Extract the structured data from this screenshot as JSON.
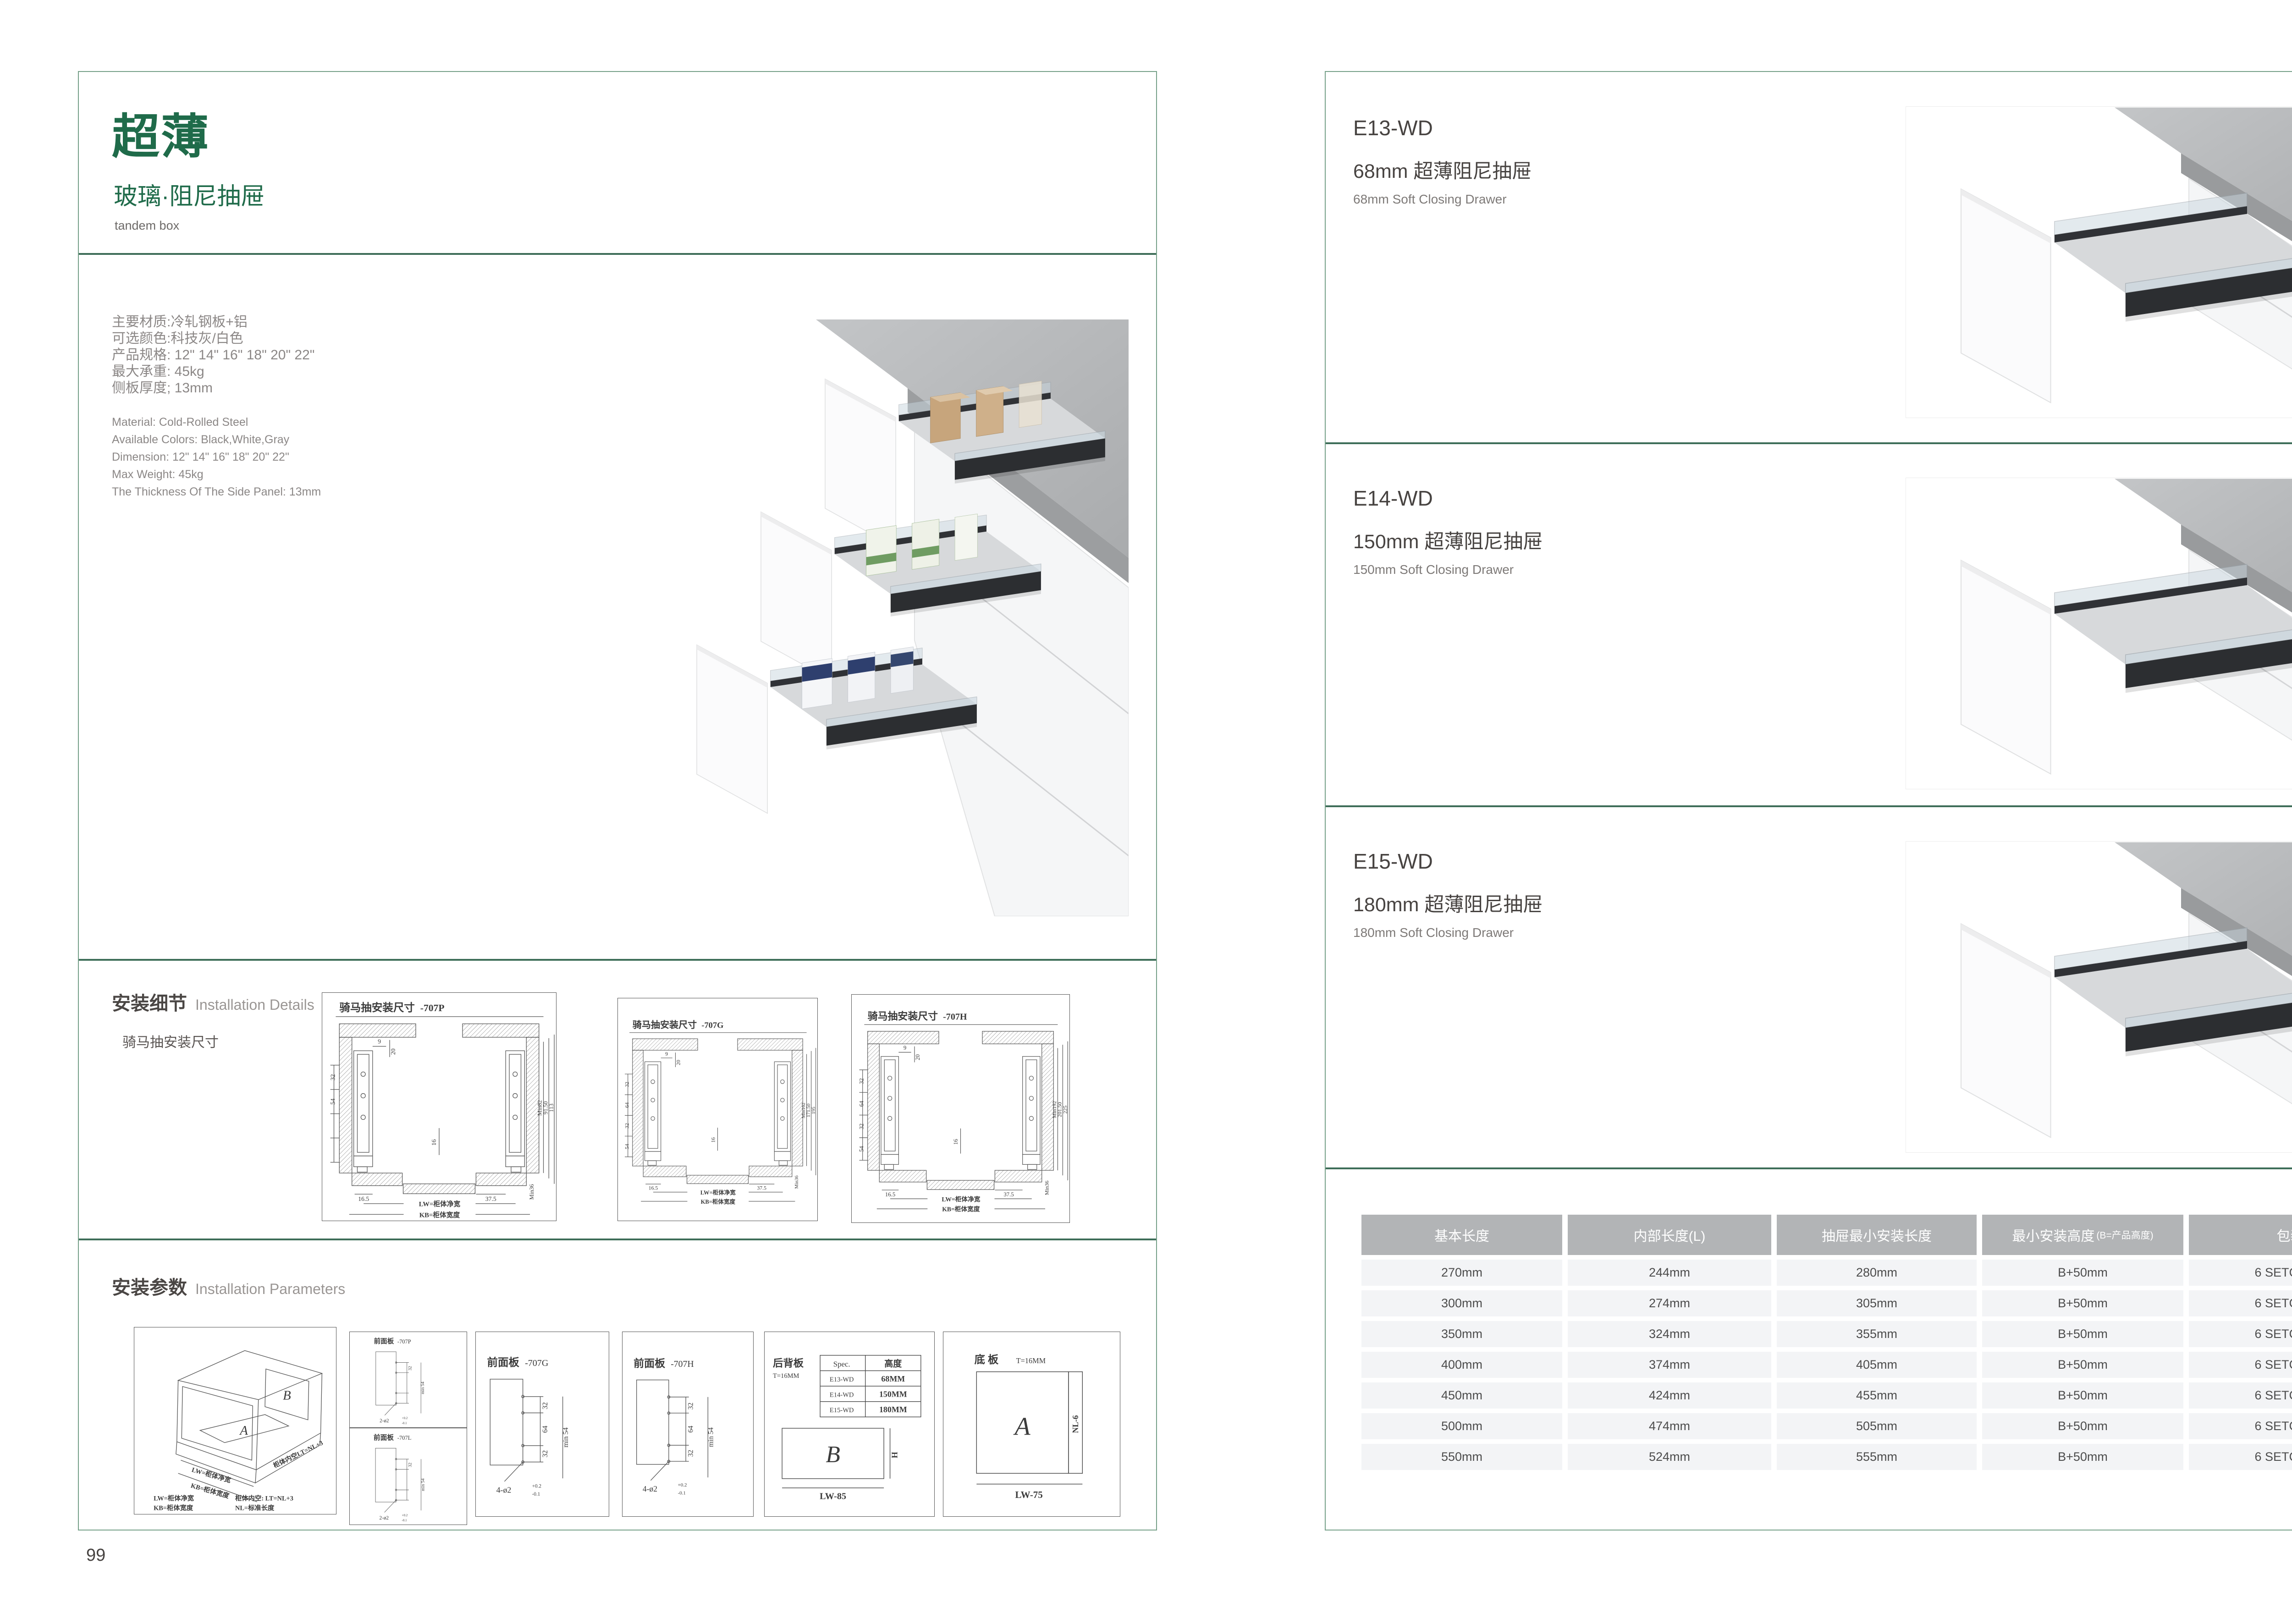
{
  "colors": {
    "brand_green": "#1f6b4a",
    "border_green": "#76a089",
    "divider_green": "#3e6e59",
    "table_header_bg": "#b2b4b6",
    "table_row_bg": "#f3f4f6"
  },
  "page_left": {
    "page_number": "99",
    "header": {
      "title": "超薄",
      "subtitle": "玻璃·阻尼抽屉",
      "tagline": "tandem box"
    },
    "specs_zh": [
      "主要材质:冷轧钢板+铝",
      "可选颜色:科技灰/白色",
      "产品规格: 12\" 14\" 16\" 18\" 20\" 22\"",
      "最大承重: 45kg",
      "侧板厚度; 13mm"
    ],
    "specs_en": [
      "Material: Cold-Rolled Steel",
      "Available Colors: Black,White,Gray",
      "Dimension: 12\" 14\" 16\" 18\" 20\" 22\"",
      "Max Weight: 45kg",
      "The Thickness Of The Side Panel: 13mm"
    ],
    "details": {
      "title_zh": "安装细节",
      "title_en": "Installation Details",
      "subtitle": "骑马抽安装尺寸",
      "drawings": [
        {
          "title": "骑马抽安装尺寸",
          "model": "-707P",
          "top_dim": "9",
          "slot_dim": "20",
          "left_dims": [
            "32",
            "54",
            "",
            ""
          ],
          "mid_dim": "16",
          "right_dims": [
            "Min82",
            "91.50",
            "113"
          ],
          "bottom_left": "16.5",
          "bottom_right": "37.5",
          "min_label": "Min36",
          "lw": "LW=柜体净宽",
          "kb": "KB=柜体宽度"
        },
        {
          "title": "骑马抽安装尺寸",
          "model": "-707G",
          "top_dim": "9",
          "slot_dim": "20",
          "left_dims": [
            "32",
            "64",
            "32",
            "54"
          ],
          "mid_dim": "16",
          "right_dims": [
            "Min162",
            "171.50",
            "195"
          ],
          "bottom_left": "16.5",
          "bottom_right": "37.5",
          "min_label": "Min36",
          "lw": "LW=柜体净宽",
          "kb": "KB=柜体宽度"
        },
        {
          "title": "骑马抽安装尺寸",
          "model": "-707H",
          "top_dim": "9",
          "slot_dim": "20",
          "left_dims": [
            "32",
            "64",
            "32",
            "54"
          ],
          "mid_dim": "16",
          "right_dims": [
            "Min192",
            "201.50",
            "225"
          ],
          "bottom_left": "16.5",
          "bottom_right": "37.5",
          "min_label": "Min36",
          "lw": "LW=柜体净宽",
          "kb": "KB=柜体宽度"
        }
      ]
    },
    "params": {
      "title_zh": "安装参数",
      "title_en": "Installation Parameters",
      "cabinet": {
        "panel_a": "A",
        "panel_b": "B",
        "lw": "LW=柜体净宽",
        "kb": "KB=柜体宽度",
        "lt": "柜体内空LT=NL+3",
        "legend": [
          "LW=柜体净宽",
          "柜体内空: LT=NL+3",
          "KB=柜体宽度",
          "NL=标准长度"
        ]
      },
      "front_panels": [
        {
          "title": "前面板",
          "model": "-707P",
          "dims": [
            "32",
            "",
            ""
          ],
          "min_label": "min 54",
          "holes": "2-ø2",
          "tol_top": "+0.2",
          "tol_bottom": "-0.1"
        },
        {
          "title": "前面板",
          "model": "-707L",
          "dims": [
            "32",
            "",
            ""
          ],
          "min_label": "min 54",
          "holes": "2-ø2",
          "tol_top": "+0.2",
          "tol_bottom": "-0.1"
        },
        {
          "title": "前面板",
          "model": "-707G",
          "dims": [
            "32",
            "64",
            "32"
          ],
          "min_label": "min 54",
          "holes": "4-ø2",
          "tol_top": "+0.2",
          "tol_bottom": "-0.1"
        },
        {
          "title": "前面板",
          "model": "-707H",
          "dims": [
            "32",
            "64",
            "32"
          ],
          "min_label": "min 54",
          "holes": "4-ø2",
          "tol_top": "+0.2",
          "tol_bottom": "-0.1"
        }
      ],
      "back_panel": {
        "title": "后背板",
        "thickness": "T=16MM",
        "spec_col": "Spec.",
        "height_col": "高度",
        "rows": [
          [
            "E13-WD",
            "68MM"
          ],
          [
            "E14-WD",
            "150MM"
          ],
          [
            "E15-WD",
            "180MM"
          ]
        ],
        "panel_label": "B",
        "height_label": "H",
        "width_label": "LW-85"
      },
      "bottom_panel": {
        "title": "底 板",
        "thickness": "T=16MM",
        "panel_label": "A",
        "side_label": "NL-6",
        "width_label": "LW-75"
      }
    }
  },
  "page_right": {
    "page_number": "100",
    "products": [
      {
        "model": "E13-WD",
        "name_zh": "68mm 超薄阻尼抽屉",
        "name_en": "68mm Soft Closing Drawer"
      },
      {
        "model": "E14-WD",
        "name_zh": "150mm 超薄阻尼抽屉",
        "name_en": "150mm Soft Closing Drawer"
      },
      {
        "model": "E15-WD",
        "name_zh": "180mm 超薄阻尼抽屉",
        "name_en": "180mm Soft Closing Drawer"
      }
    ],
    "table": {
      "headers": [
        "基本长度",
        "内部长度(L)",
        "抽屉最小安装长度",
        "最小安装高度",
        "包装"
      ],
      "header_note": "(B=产品高度)",
      "rows": [
        [
          "270mm",
          "244mm",
          "280mm",
          "B+50mm",
          "6 SETC/TNB"
        ],
        [
          "300mm",
          "274mm",
          "305mm",
          "B+50mm",
          "6 SETC/TNB"
        ],
        [
          "350mm",
          "324mm",
          "355mm",
          "B+50mm",
          "6 SETC/TNB"
        ],
        [
          "400mm",
          "374mm",
          "405mm",
          "B+50mm",
          "6 SETC/TNB"
        ],
        [
          "450mm",
          "424mm",
          "455mm",
          "B+50mm",
          "6 SETC/TNB"
        ],
        [
          "500mm",
          "474mm",
          "505mm",
          "B+50mm",
          "6 SETC/TNB"
        ],
        [
          "550mm",
          "524mm",
          "555mm",
          "B+50mm",
          "6 SETC/TNB"
        ]
      ]
    }
  }
}
